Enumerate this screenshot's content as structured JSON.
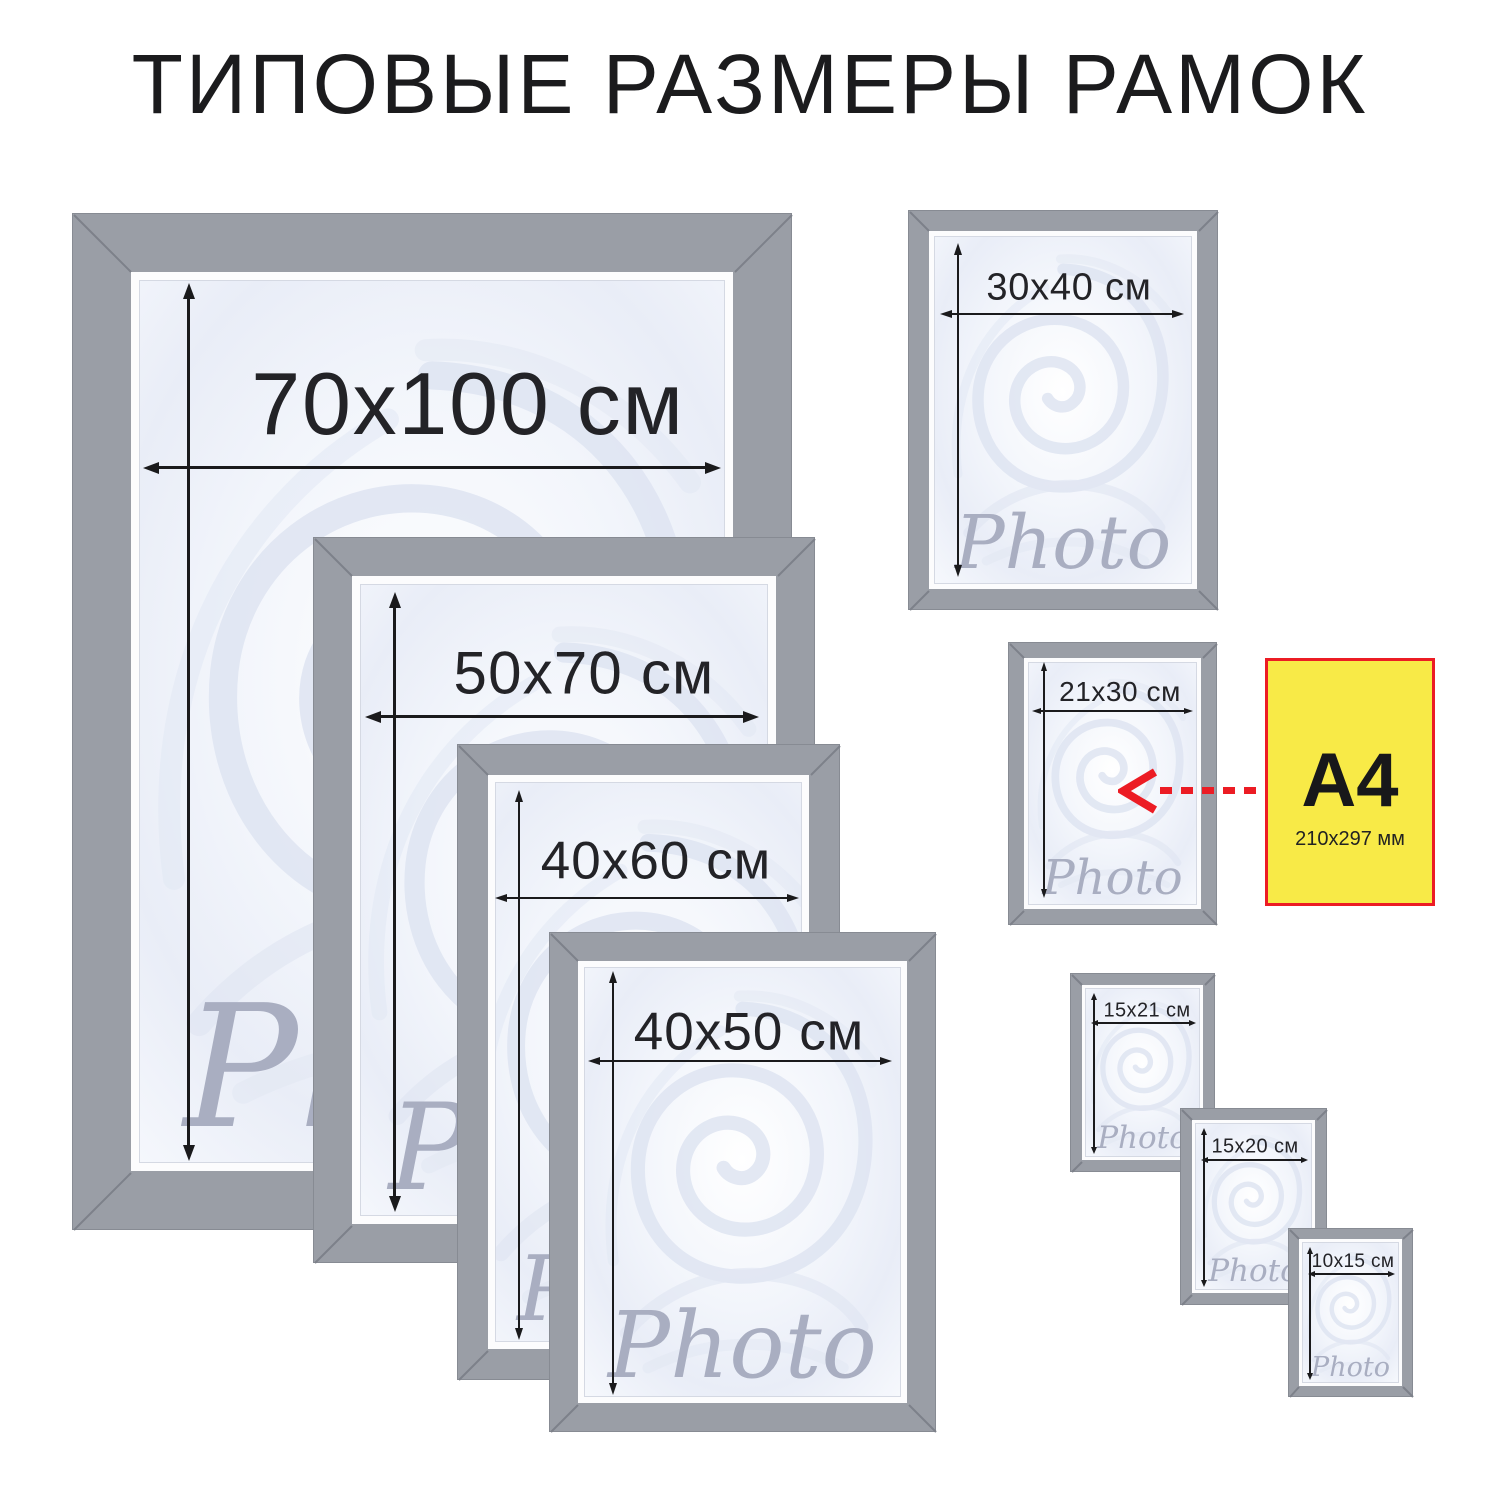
{
  "title": "ТИПОВЫЕ РАЗМЕРЫ РАМОК",
  "watermark_text": "Photo",
  "frames": [
    {
      "size_label": "70x100 см"
    },
    {
      "size_label": "50x70 см"
    },
    {
      "size_label": "40x60 см"
    },
    {
      "size_label": "40x50 см"
    },
    {
      "size_label": "30x40 см"
    },
    {
      "size_label": "21x30 см"
    },
    {
      "size_label": "15x21 см"
    },
    {
      "size_label": "15x20 см"
    },
    {
      "size_label": "10x15 см"
    }
  ],
  "a4_note": {
    "label": "A4",
    "dimensions": "210x297 мм"
  },
  "colors": {
    "frame_gray": "#9a9ea6",
    "miter_seam_gray": "#7d818a",
    "accent_red": "#ec1c24",
    "note_yellow": "#f8ea47",
    "watermark_gray": "#a6abbf",
    "text_dark": "#1b1b1d"
  }
}
